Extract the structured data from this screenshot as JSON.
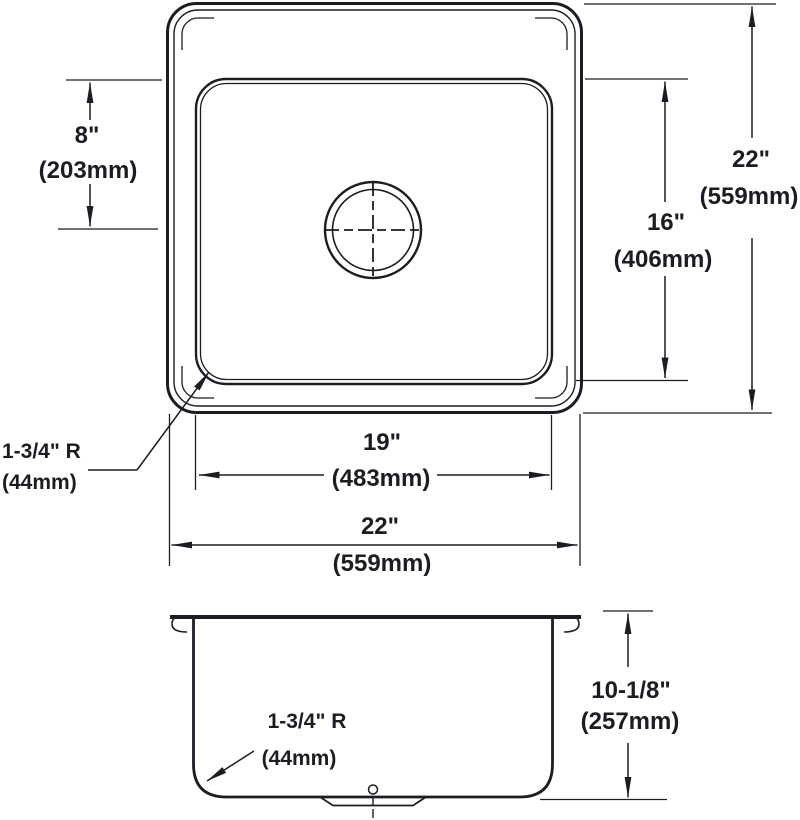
{
  "colors": {
    "line": "#1c1c22",
    "background": "#ffffff"
  },
  "top_view": {
    "bowl_top_to_drain": {
      "in": "8\"",
      "mm": "(203mm)"
    },
    "bowl_front_to_back": {
      "in": "16\"",
      "mm": "(406mm)"
    },
    "overall_front_to_back": {
      "in": "22\"",
      "mm": "(559mm)"
    },
    "bowl_left_to_right": {
      "in": "19\"",
      "mm": "(483mm)"
    },
    "overall_left_to_right": {
      "in": "22\"",
      "mm": "(559mm)"
    },
    "bowl_corner_radius": {
      "in": "1-3/4\" R",
      "mm": "(44mm)"
    }
  },
  "side_view": {
    "overall_depth": {
      "in": "10-1/8\"",
      "mm": "(257mm)"
    },
    "bottom_corner_radius": {
      "in": "1-3/4\" R",
      "mm": "(44mm)"
    }
  }
}
